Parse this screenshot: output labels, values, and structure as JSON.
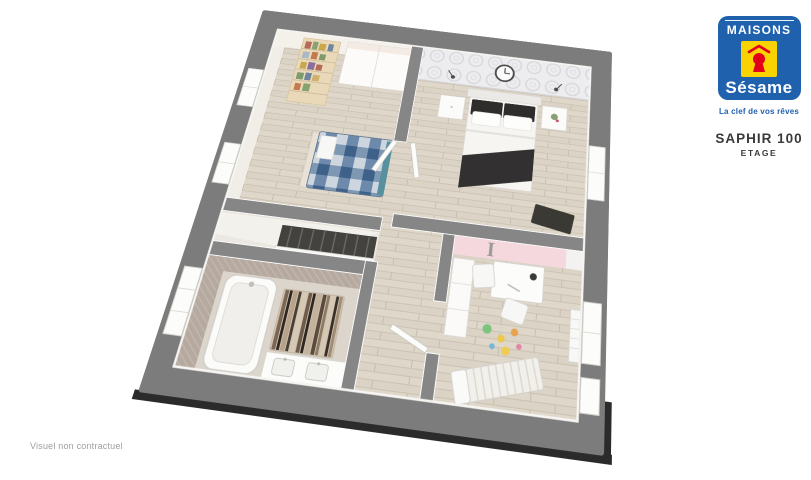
{
  "brand": {
    "name_top": "MAISONS",
    "name_script": "Sésame",
    "tagline": "La clef de vos rêves",
    "colors": {
      "blue": "#2061ae",
      "yellow": "#f8d301",
      "red": "#e2001a"
    }
  },
  "title": {
    "model": "SAPHIR 100",
    "level": "ETAGE"
  },
  "footer": {
    "disclaimer": "Visuel non contractuel"
  },
  "plan": {
    "frame_color": "#7c7c7c",
    "floor_wood_color": "#ded7ca",
    "accent_wall_color": "#f5d7de",
    "wallpaper_color": "#ededef",
    "bathroom_wall_color": "#b6aaa0",
    "wall_letter": "I",
    "rooms": [
      "bedroom-1",
      "master-bedroom",
      "kids-bedroom",
      "bathroom",
      "landing",
      "stairwell"
    ]
  }
}
